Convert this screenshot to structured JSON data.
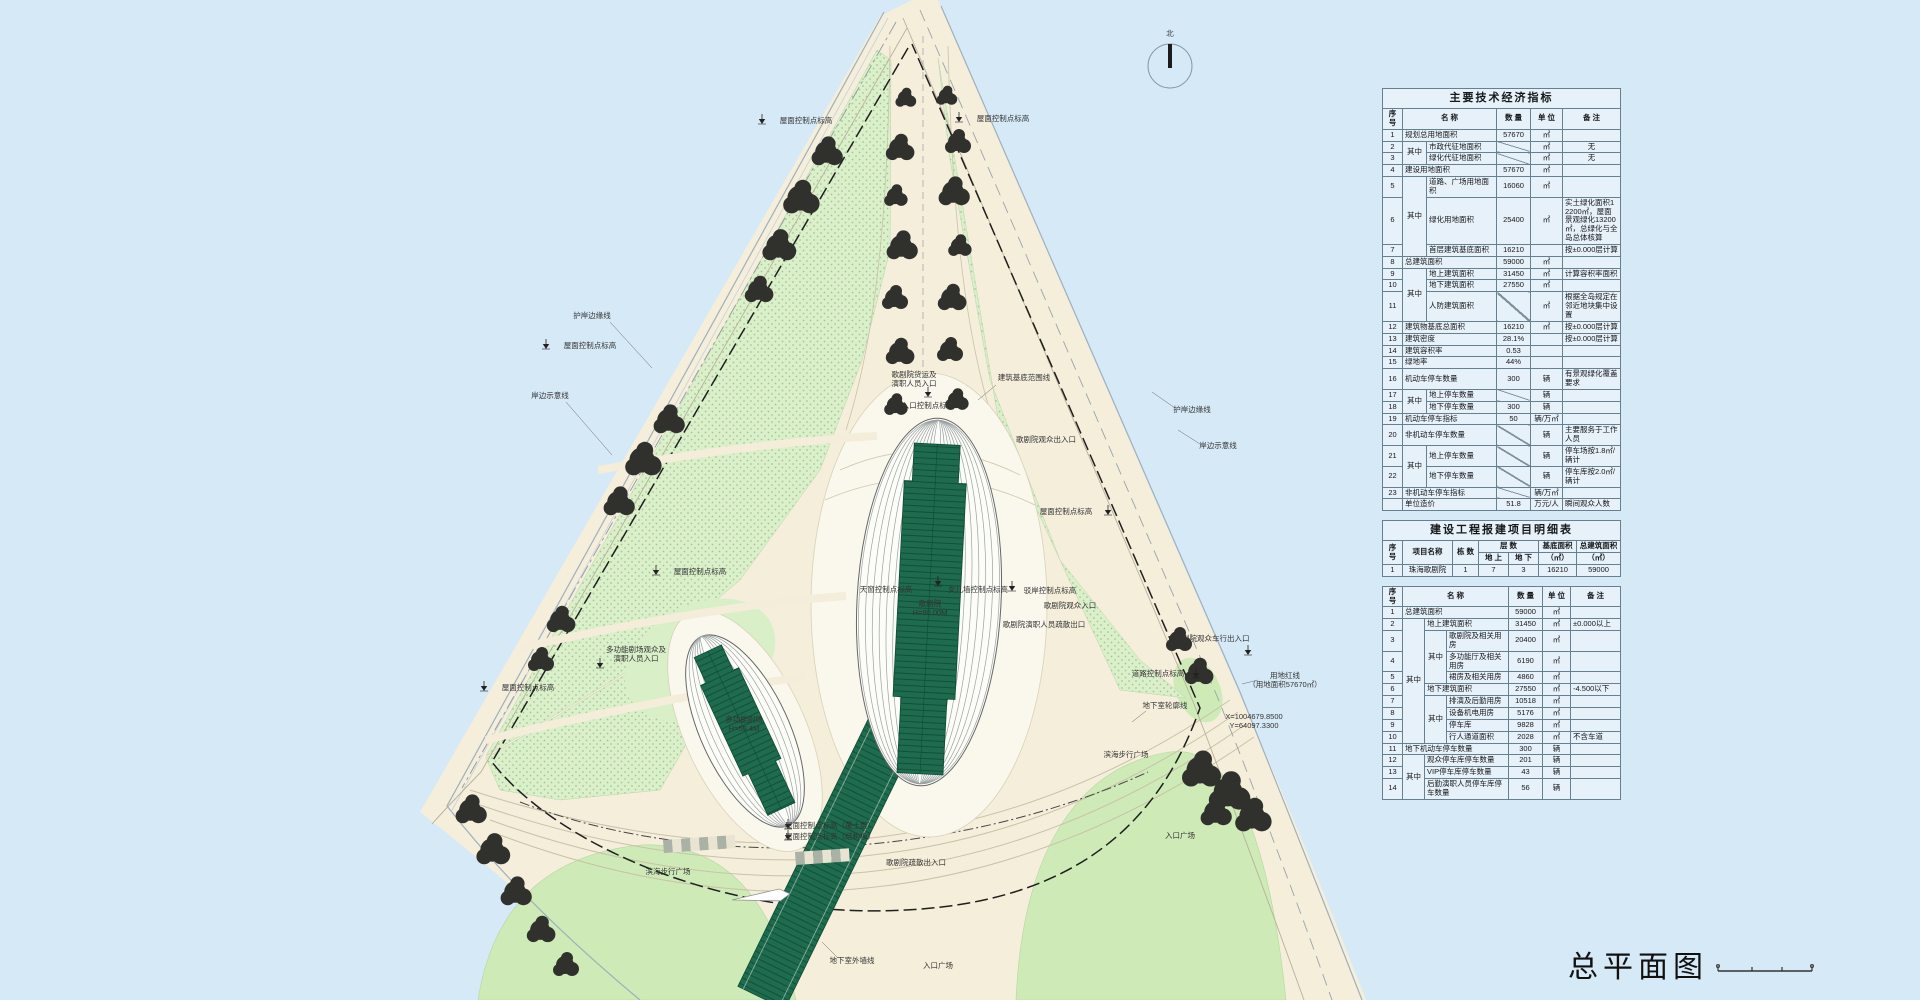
{
  "north_label": "北",
  "drawing_title": "总平面图",
  "colors": {
    "water": "#d6e9f7",
    "paving": "#f4eedb",
    "lawn": "#cdeab7",
    "planting": "#dcefcb",
    "shell_green": "#1e6b4e",
    "tree": "#30302c",
    "table_bg": "#e7f1f9",
    "table_border": "#67808f"
  },
  "plan": {
    "labels": [
      {
        "text": "屋面控制点标高",
        "x": 806,
        "y": 123,
        "mk": [
          762,
          124
        ]
      },
      {
        "text": "屋面控制点标高",
        "x": 1003,
        "y": 121,
        "mk": [
          959,
          122
        ]
      },
      {
        "text": "屋面控制点标高",
        "x": 1066,
        "y": 514,
        "mk": [
          1108,
          515
        ]
      },
      {
        "text": "屋面控制点标高",
        "x": 590,
        "y": 348,
        "mk": [
          546,
          349
        ]
      },
      {
        "text": "屋面控制点标高",
        "x": 700,
        "y": 574,
        "mk": [
          656,
          575
        ]
      },
      {
        "text": "屋面控制点标高",
        "x": 528,
        "y": 690,
        "mk": [
          484,
          691
        ]
      },
      {
        "text": "屋面控制点标高（覆土层）",
        "x": 830,
        "y": 828,
        "mk": [
          788,
          829
        ]
      },
      {
        "text": "屋面控制点标高（结构板）",
        "x": 830,
        "y": 839,
        "mk": [
          788,
          840
        ]
      },
      {
        "text": "护岸边缘线",
        "x": 592,
        "y": 318,
        "lead": [
          610,
          322,
          652,
          368
        ]
      },
      {
        "text": "岸边示意线",
        "x": 550,
        "y": 398,
        "lead": [
          566,
          402,
          612,
          455
        ]
      },
      {
        "text": "护岸边缘线",
        "x": 1192,
        "y": 412,
        "lead": [
          1175,
          408,
          1152,
          392
        ]
      },
      {
        "text": "岸边示意线",
        "x": 1218,
        "y": 448,
        "lead": [
          1200,
          444,
          1178,
          430
        ]
      },
      {
        "lines": [
          "用地红线",
          "（用地面积57670㎡）"
        ],
        "x": 1285,
        "y": 678,
        "lead": [
          1242,
          684,
          1258,
          680
        ]
      },
      {
        "text": "地下室轮廓线",
        "x": 1165,
        "y": 708,
        "lead": [
          1132,
          722,
          1146,
          711
        ]
      },
      {
        "text": "地下室外墙线",
        "x": 852,
        "y": 963,
        "lead": [
          822,
          942,
          838,
          958
        ]
      },
      {
        "text": "滨海步行广场",
        "x": 668,
        "y": 874
      },
      {
        "text": "滨海步行广场",
        "x": 1126,
        "y": 757
      },
      {
        "text": "入口广场",
        "x": 938,
        "y": 968
      },
      {
        "text": "入口广场",
        "x": 1180,
        "y": 838
      },
      {
        "lines": [
          "歌剧院",
          "H=90.00M"
        ],
        "x": 930,
        "y": 606,
        "fill": "#0d2a1e"
      },
      {
        "lines": [
          "多功能剧场",
          "H=55.4M"
        ],
        "x": 744,
        "y": 722,
        "fill": "#0d2a1e"
      },
      {
        "text": "天窗控制点标高",
        "x": 886,
        "y": 592,
        "mk": [
          938,
          586
        ]
      },
      {
        "text": "女儿墙控制点标高",
        "x": 978,
        "y": 592
      },
      {
        "text": "驳岸控制点标高",
        "x": 1050,
        "y": 593,
        "mk": [
          1012,
          591
        ]
      },
      {
        "text": "歌剧院观众入口",
        "x": 1070,
        "y": 608
      },
      {
        "text": "歌剧院演职人员疏散出口",
        "x": 1044,
        "y": 627
      },
      {
        "lines": [
          "多功能剧场观众及",
          "演职人员入口"
        ],
        "x": 636,
        "y": 652,
        "mk": [
          600,
          668
        ]
      },
      {
        "lines": [
          "歌剧院货运及",
          "演职人员入口"
        ],
        "x": 914,
        "y": 377
      },
      {
        "text": "入口控制点标高",
        "x": 928,
        "y": 408,
        "mk": [
          928,
          397
        ]
      },
      {
        "text": "建筑基底范围线",
        "x": 1024,
        "y": 380,
        "lead": [
          978,
          400,
          996,
          385
        ]
      },
      {
        "text": "歌剧院观众出入口",
        "x": 1046,
        "y": 442
      },
      {
        "text": "歌剧院观众车行出入口",
        "x": 1212,
        "y": 641,
        "mk": [
          1248,
          655
        ]
      },
      {
        "text": "道路控制点标高",
        "x": 1158,
        "y": 676,
        "mk": [
          1196,
          678
        ]
      },
      {
        "lines": [
          "X=1004679.8500",
          "Y=64097.3300"
        ],
        "x": 1254,
        "y": 719,
        "fs": 6.5,
        "fill": "#555"
      },
      {
        "text": "歌剧院疏散出入口",
        "x": 916,
        "y": 865
      }
    ]
  },
  "tables": {
    "t1": {
      "rows": [
        [
          {
            "t": "主要技术经济指标",
            "cs": 6,
            "c": "title"
          }
        ],
        [
          {
            "t": "序 号",
            "c": "hdr"
          },
          {
            "t": "名    称",
            "cs": 2,
            "c": "hdr"
          },
          {
            "t": "数 量",
            "c": "hdr"
          },
          {
            "t": "单 位",
            "c": "hdr"
          },
          {
            "t": "备  注",
            "c": "hdr"
          }
        ],
        [
          {
            "t": "1"
          },
          {
            "t": "规划总用地面积",
            "cs": 2,
            "c": "left"
          },
          {
            "t": "57670"
          },
          {
            "t": "㎡"
          },
          {
            "t": ""
          }
        ],
        [
          {
            "t": "2"
          },
          {
            "t": "其中",
            "rs": 2
          },
          {
            "t": "市政代征地面积",
            "c": "left"
          },
          {
            "t": "",
            "c": "diag"
          },
          {
            "t": "㎡"
          },
          {
            "t": "无"
          }
        ],
        [
          {
            "t": "3"
          },
          {
            "t": "绿化代征地面积",
            "c": "left"
          },
          {
            "t": "",
            "c": "diag"
          },
          {
            "t": "㎡"
          },
          {
            "t": "无"
          }
        ],
        [
          {
            "t": "4"
          },
          {
            "t": "建设用地面积",
            "cs": 2,
            "c": "left"
          },
          {
            "t": "57670"
          },
          {
            "t": "㎡"
          },
          {
            "t": ""
          }
        ],
        [
          {
            "t": "5"
          },
          {
            "t": "其中",
            "rs": 3
          },
          {
            "t": "道路、广场用地面积",
            "c": "left"
          },
          {
            "t": "16060"
          },
          {
            "t": "㎡"
          },
          {
            "t": ""
          }
        ],
        [
          {
            "t": "6"
          },
          {
            "t": "绿化用地面积",
            "c": "left"
          },
          {
            "t": "25400"
          },
          {
            "t": "㎡"
          },
          {
            "t": "实土绿化面积12200㎡，屋面景观绿化13200㎡，总绿化与全岛总体核算",
            "c": "left"
          }
        ],
        [
          {
            "t": "7"
          },
          {
            "t": "首层建筑基底面积",
            "c": "left"
          },
          {
            "t": "16210"
          },
          {
            "t": ""
          },
          {
            "t": "按±0.000层计算",
            "c": "left"
          }
        ],
        [
          {
            "t": "8"
          },
          {
            "t": "总建筑面积",
            "cs": 2,
            "c": "left"
          },
          {
            "t": "59000"
          },
          {
            "t": "㎡"
          },
          {
            "t": ""
          }
        ],
        [
          {
            "t": "9"
          },
          {
            "t": "其中",
            "rs": 3
          },
          {
            "t": "地上建筑面积",
            "c": "left"
          },
          {
            "t": "31450"
          },
          {
            "t": "㎡"
          },
          {
            "t": "计算容积率面积",
            "c": "left"
          }
        ],
        [
          {
            "t": "10"
          },
          {
            "t": "地下建筑面积",
            "c": "left"
          },
          {
            "t": "27550"
          },
          {
            "t": "㎡"
          },
          {
            "t": ""
          }
        ],
        [
          {
            "t": "11"
          },
          {
            "t": "人防建筑面积",
            "c": "left"
          },
          {
            "t": "",
            "c": "diag"
          },
          {
            "t": "㎡"
          },
          {
            "t": "根据全岛规定在邻近地块集中设置",
            "c": "left"
          }
        ],
        [
          {
            "t": "12"
          },
          {
            "t": "建筑物基底总面积",
            "cs": 2,
            "c": "left"
          },
          {
            "t": "16210"
          },
          {
            "t": "㎡"
          },
          {
            "t": "按±0.000层计算",
            "c": "left"
          }
        ],
        [
          {
            "t": "13"
          },
          {
            "t": "建筑密度",
            "cs": 2,
            "c": "left"
          },
          {
            "t": "28.1%"
          },
          {
            "t": ""
          },
          {
            "t": "按±0.000层计算",
            "c": "left"
          }
        ],
        [
          {
            "t": "14"
          },
          {
            "t": "建筑容积率",
            "cs": 2,
            "c": "left"
          },
          {
            "t": "0.53"
          },
          {
            "t": ""
          },
          {
            "t": ""
          }
        ],
        [
          {
            "t": "15"
          },
          {
            "t": "绿地率",
            "cs": 2,
            "c": "left"
          },
          {
            "t": "44%"
          },
          {
            "t": ""
          },
          {
            "t": ""
          }
        ],
        [
          {
            "t": "16"
          },
          {
            "t": "机动车停车数量",
            "cs": 2,
            "c": "left"
          },
          {
            "t": "300"
          },
          {
            "t": "辆"
          },
          {
            "t": "有景观绿化覆盖要求",
            "c": "left"
          }
        ],
        [
          {
            "t": "17"
          },
          {
            "t": "其中",
            "rs": 2
          },
          {
            "t": "地上停车数量",
            "c": "left"
          },
          {
            "t": "",
            "c": "diag"
          },
          {
            "t": "辆"
          },
          {
            "t": ""
          }
        ],
        [
          {
            "t": "18"
          },
          {
            "t": "地下停车数量",
            "c": "left"
          },
          {
            "t": "300"
          },
          {
            "t": "辆"
          },
          {
            "t": ""
          }
        ],
        [
          {
            "t": "19"
          },
          {
            "t": "机动车停车指标",
            "cs": 2,
            "c": "left"
          },
          {
            "t": "50"
          },
          {
            "t": "辆/万㎡"
          },
          {
            "t": ""
          }
        ],
        [
          {
            "t": "20"
          },
          {
            "t": "非机动车停车数量",
            "cs": 2,
            "c": "left"
          },
          {
            "t": "",
            "c": "diag"
          },
          {
            "t": "辆"
          },
          {
            "t": "主要服务于工作人员",
            "c": "left"
          }
        ],
        [
          {
            "t": "21"
          },
          {
            "t": "其中",
            "rs": 2
          },
          {
            "t": "地上停车数量",
            "c": "left"
          },
          {
            "t": "",
            "c": "diag"
          },
          {
            "t": "辆"
          },
          {
            "t": "停车场按1.8㎡/辆计",
            "c": "left"
          }
        ],
        [
          {
            "t": "22"
          },
          {
            "t": "地下停车数量",
            "c": "left"
          },
          {
            "t": "",
            "c": "diag"
          },
          {
            "t": "辆"
          },
          {
            "t": "停车库按2.0㎡/辆计",
            "c": "left"
          }
        ],
        [
          {
            "t": "23"
          },
          {
            "t": "非机动车停车指标",
            "cs": 2,
            "c": "left"
          },
          {
            "t": "",
            "c": "diag"
          },
          {
            "t": "辆/万㎡"
          },
          {
            "t": ""
          }
        ],
        [
          {
            "t": ""
          },
          {
            "t": "单位造价",
            "cs": 2,
            "c": "left"
          },
          {
            "t": "51.8"
          },
          {
            "t": "万元/人"
          },
          {
            "t": "瞬间观众人数",
            "c": "left"
          }
        ]
      ]
    },
    "t2": {
      "rows": [
        [
          {
            "t": "建设工程报建项目明细表",
            "cs": 7,
            "c": "title"
          }
        ],
        [
          {
            "t": "序 号",
            "rs": 2,
            "c": "hdr"
          },
          {
            "t": "项目名称",
            "rs": 2,
            "c": "hdr"
          },
          {
            "t": "栋 数",
            "rs": 2,
            "c": "hdr"
          },
          {
            "t": "层  数",
            "cs": 2,
            "c": "hdr"
          },
          {
            "t": "基底面积",
            "c": "hdr"
          },
          {
            "t": "总建筑面积",
            "c": "hdr"
          }
        ],
        [
          {
            "t": "地 上",
            "c": "hdr"
          },
          {
            "t": "地 下",
            "c": "hdr"
          },
          {
            "t": "（㎡）",
            "c": "hdr"
          },
          {
            "t": "（㎡）",
            "c": "hdr"
          }
        ],
        [
          {
            "t": "1"
          },
          {
            "t": "珠海歌剧院"
          },
          {
            "t": "1"
          },
          {
            "t": "7"
          },
          {
            "t": "3"
          },
          {
            "t": "16210"
          },
          {
            "t": "59000"
          }
        ]
      ]
    },
    "t3": {
      "rows": [
        [
          {
            "t": "序 号",
            "c": "hdr"
          },
          {
            "t": "名    称",
            "cs": 3,
            "c": "hdr"
          },
          {
            "t": "数 量",
            "c": "hdr"
          },
          {
            "t": "单 位",
            "c": "hdr"
          },
          {
            "t": "备  注",
            "c": "hdr"
          }
        ],
        [
          {
            "t": "1"
          },
          {
            "t": "总建筑面积",
            "cs": 3,
            "c": "left"
          },
          {
            "t": "59000"
          },
          {
            "t": "㎡"
          },
          {
            "t": ""
          }
        ],
        [
          {
            "t": "2"
          },
          {
            "t": "其中",
            "rs": 9
          },
          {
            "t": "地上建筑面积",
            "cs": 2,
            "c": "left"
          },
          {
            "t": "31450"
          },
          {
            "t": "㎡"
          },
          {
            "t": "±0.000以上",
            "c": "left"
          }
        ],
        [
          {
            "t": "3"
          },
          {
            "t": "其中",
            "rs": 3
          },
          {
            "t": "歌剧院及相关用房",
            "c": "left"
          },
          {
            "t": "20400"
          },
          {
            "t": "㎡"
          },
          {
            "t": ""
          }
        ],
        [
          {
            "t": "4"
          },
          {
            "t": "多功能厅及相关用房",
            "c": "left"
          },
          {
            "t": "6190"
          },
          {
            "t": "㎡"
          },
          {
            "t": ""
          }
        ],
        [
          {
            "t": "5"
          },
          {
            "t": "裙房及相关用房",
            "c": "left"
          },
          {
            "t": "4860"
          },
          {
            "t": "㎡"
          },
          {
            "t": ""
          }
        ],
        [
          {
            "t": "6"
          },
          {
            "t": "地下建筑面积",
            "cs": 2,
            "c": "left"
          },
          {
            "t": "27550"
          },
          {
            "t": "㎡"
          },
          {
            "t": "-4.500以下",
            "c": "left"
          }
        ],
        [
          {
            "t": "7"
          },
          {
            "t": "其中",
            "rs": 4
          },
          {
            "t": "排演及后勤用房",
            "c": "left"
          },
          {
            "t": "10518"
          },
          {
            "t": "㎡"
          },
          {
            "t": ""
          }
        ],
        [
          {
            "t": "8"
          },
          {
            "t": "设备机电用房",
            "c": "left"
          },
          {
            "t": "5176"
          },
          {
            "t": "㎡"
          },
          {
            "t": ""
          }
        ],
        [
          {
            "t": "9"
          },
          {
            "t": "停车库",
            "c": "left"
          },
          {
            "t": "9828"
          },
          {
            "t": "㎡"
          },
          {
            "t": ""
          }
        ],
        [
          {
            "t": "10"
          },
          {
            "t": "行人通道面积",
            "c": "left"
          },
          {
            "t": "2028"
          },
          {
            "t": "㎡"
          },
          {
            "t": "不含车道",
            "c": "left"
          }
        ],
        [
          {
            "t": "11"
          },
          {
            "t": "地下机动车停车数量",
            "cs": 3,
            "c": "left"
          },
          {
            "t": "300"
          },
          {
            "t": "辆"
          },
          {
            "t": ""
          }
        ],
        [
          {
            "t": "12"
          },
          {
            "t": "其中",
            "rs": 3
          },
          {
            "t": "观众停车库停车数量",
            "cs": 2,
            "c": "left"
          },
          {
            "t": "201"
          },
          {
            "t": "辆"
          },
          {
            "t": ""
          }
        ],
        [
          {
            "t": "13"
          },
          {
            "t": "VIP停车库停车数量",
            "cs": 2,
            "c": "left"
          },
          {
            "t": "43"
          },
          {
            "t": "辆"
          },
          {
            "t": ""
          }
        ],
        [
          {
            "t": "14"
          },
          {
            "t": "后勤演职人员停车库停车数量",
            "cs": 2,
            "c": "left"
          },
          {
            "t": "56"
          },
          {
            "t": "辆"
          },
          {
            "t": ""
          }
        ]
      ]
    }
  }
}
